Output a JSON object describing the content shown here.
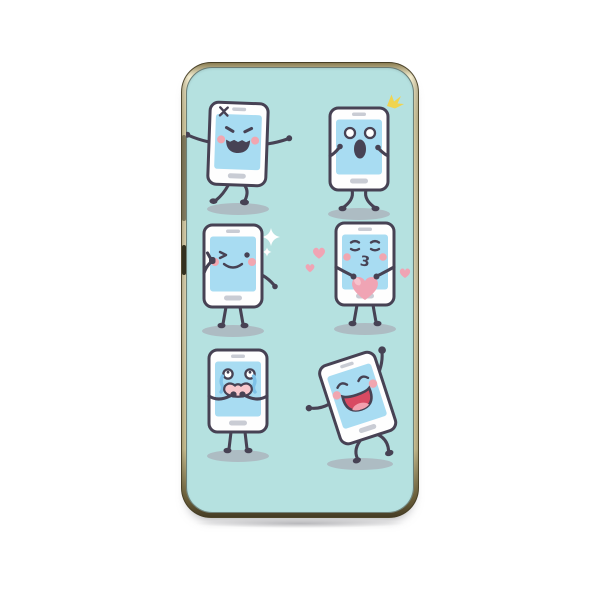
{
  "scene": {
    "type": "product-photo",
    "subject": "Gold-framed phone case printed with six cartoon smartphone emoji characters on a pastel teal background"
  },
  "colors": {
    "canvas_bg": "#ffffff",
    "print_bg": "#b5e1e0",
    "phone_body": "#fefefe",
    "phone_outline": "#474254",
    "screen_blue": "#a8dcf2",
    "detail_gray": "#c9ccd4",
    "cheek_pink": "#f1a6b0",
    "heart_pink": "#f0a4b4",
    "heart_light": "#f7c2cd",
    "tear_blue": "#7fc2e8",
    "mouth_red": "#d84a62",
    "tongue_pink": "#f2a0ae",
    "mouth_pink": "#f8c8cd",
    "sparkle_white": "#ffffff",
    "sparkle_yellow": "#f0d44f",
    "shadow_gray": "#a9adb6",
    "frame_gold_light": "#f4edcf",
    "frame_gold_dark": "#453c25"
  },
  "characters": [
    {
      "emotion": "angry smartphone",
      "pose": "stomping with arms out",
      "accent": "anger-mark",
      "grid": "top-left"
    },
    {
      "emotion": "shocked smartphone",
      "pose": "hands to face, knees bent",
      "accent": "yellow-sparkle",
      "grid": "top-right"
    },
    {
      "emotion": "winking smartphone",
      "pose": "thumbs up",
      "accent": "white-sparkles",
      "grid": "middle-left"
    },
    {
      "emotion": "kissing smartphone",
      "pose": "holding a big heart",
      "accent": "floating-hearts",
      "grid": "middle-right",
      "mouth_text": "3"
    },
    {
      "emotion": "crying smartphone",
      "pose": "hands over mouth, tears falling",
      "accent": "tears",
      "grid": "bottom-left"
    },
    {
      "emotion": "laughing smartphone",
      "pose": "dancing tilted with arm raised",
      "accent": "",
      "grid": "bottom-right"
    }
  ]
}
